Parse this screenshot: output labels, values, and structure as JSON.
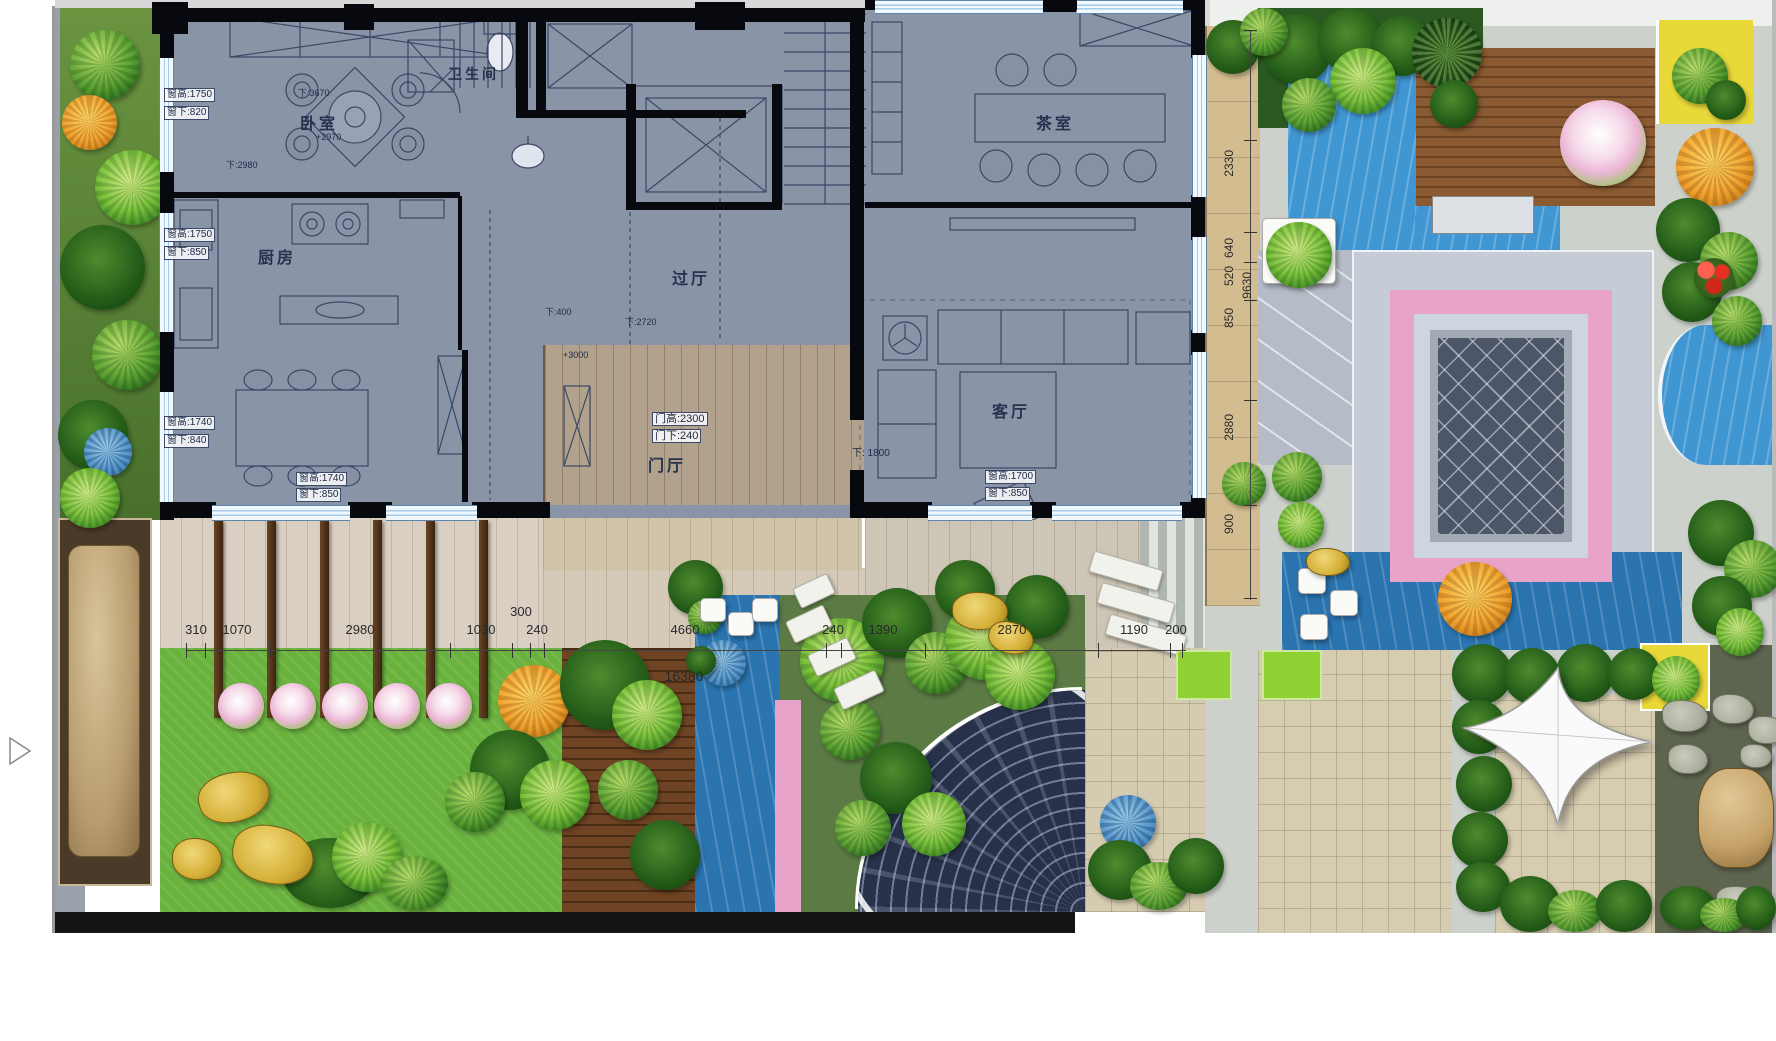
{
  "plan": {
    "rooms": {
      "bedroom": "卧室",
      "bathroom": "卫生间",
      "kitchen": "厨房",
      "hallway": "过厅",
      "foyer": "门厅",
      "tearoom": "茶室",
      "living": "客厅"
    },
    "annotations": {
      "bed_win_h": "窗高:1750",
      "bed_win_s": "窗下:820",
      "bed_m1": "下:3670",
      "bed_m2": "+2970",
      "bed_m3": "下:2980",
      "kit_win_h": "窗高:1750",
      "kit_win_s": "窗下:850",
      "din_win_h": "窗高:1740",
      "din_win_s": "窗下:840",
      "din_win_h2": "窗高:1740",
      "din_win_s2": "窗下:850",
      "hall_m1": "下:400",
      "hall_m2": "下:2720",
      "hall_m3": "+3000",
      "foyer_door_h": "门高:2300",
      "foyer_door_s": "门下:240",
      "liv_m1": "下: 1800",
      "liv_win_h": "窗高:1700",
      "liv_win_s": "窗下:850"
    }
  },
  "dims": {
    "h": [
      "310",
      "1070",
      "2980",
      "1030",
      "300",
      "240",
      "4660",
      "240",
      "1390",
      "2870",
      "1190",
      "200"
    ],
    "h_total": "16380",
    "v": [
      "2330",
      "640",
      "520",
      "850",
      "2880",
      "900"
    ],
    "v_total": "9630"
  },
  "colors": {
    "room_fill": "#8a94a7",
    "wall": "#08080f",
    "wood_floor": "#b2a18c",
    "terrace": "#d9cfc2",
    "water": "#3f96d2",
    "lawn": "#69b23d",
    "pink_band": "#e8a4c8",
    "deck_wood": "#7a4e2a",
    "dim_strip": "#d3bd90",
    "accent_yellow": "#e8d838"
  }
}
